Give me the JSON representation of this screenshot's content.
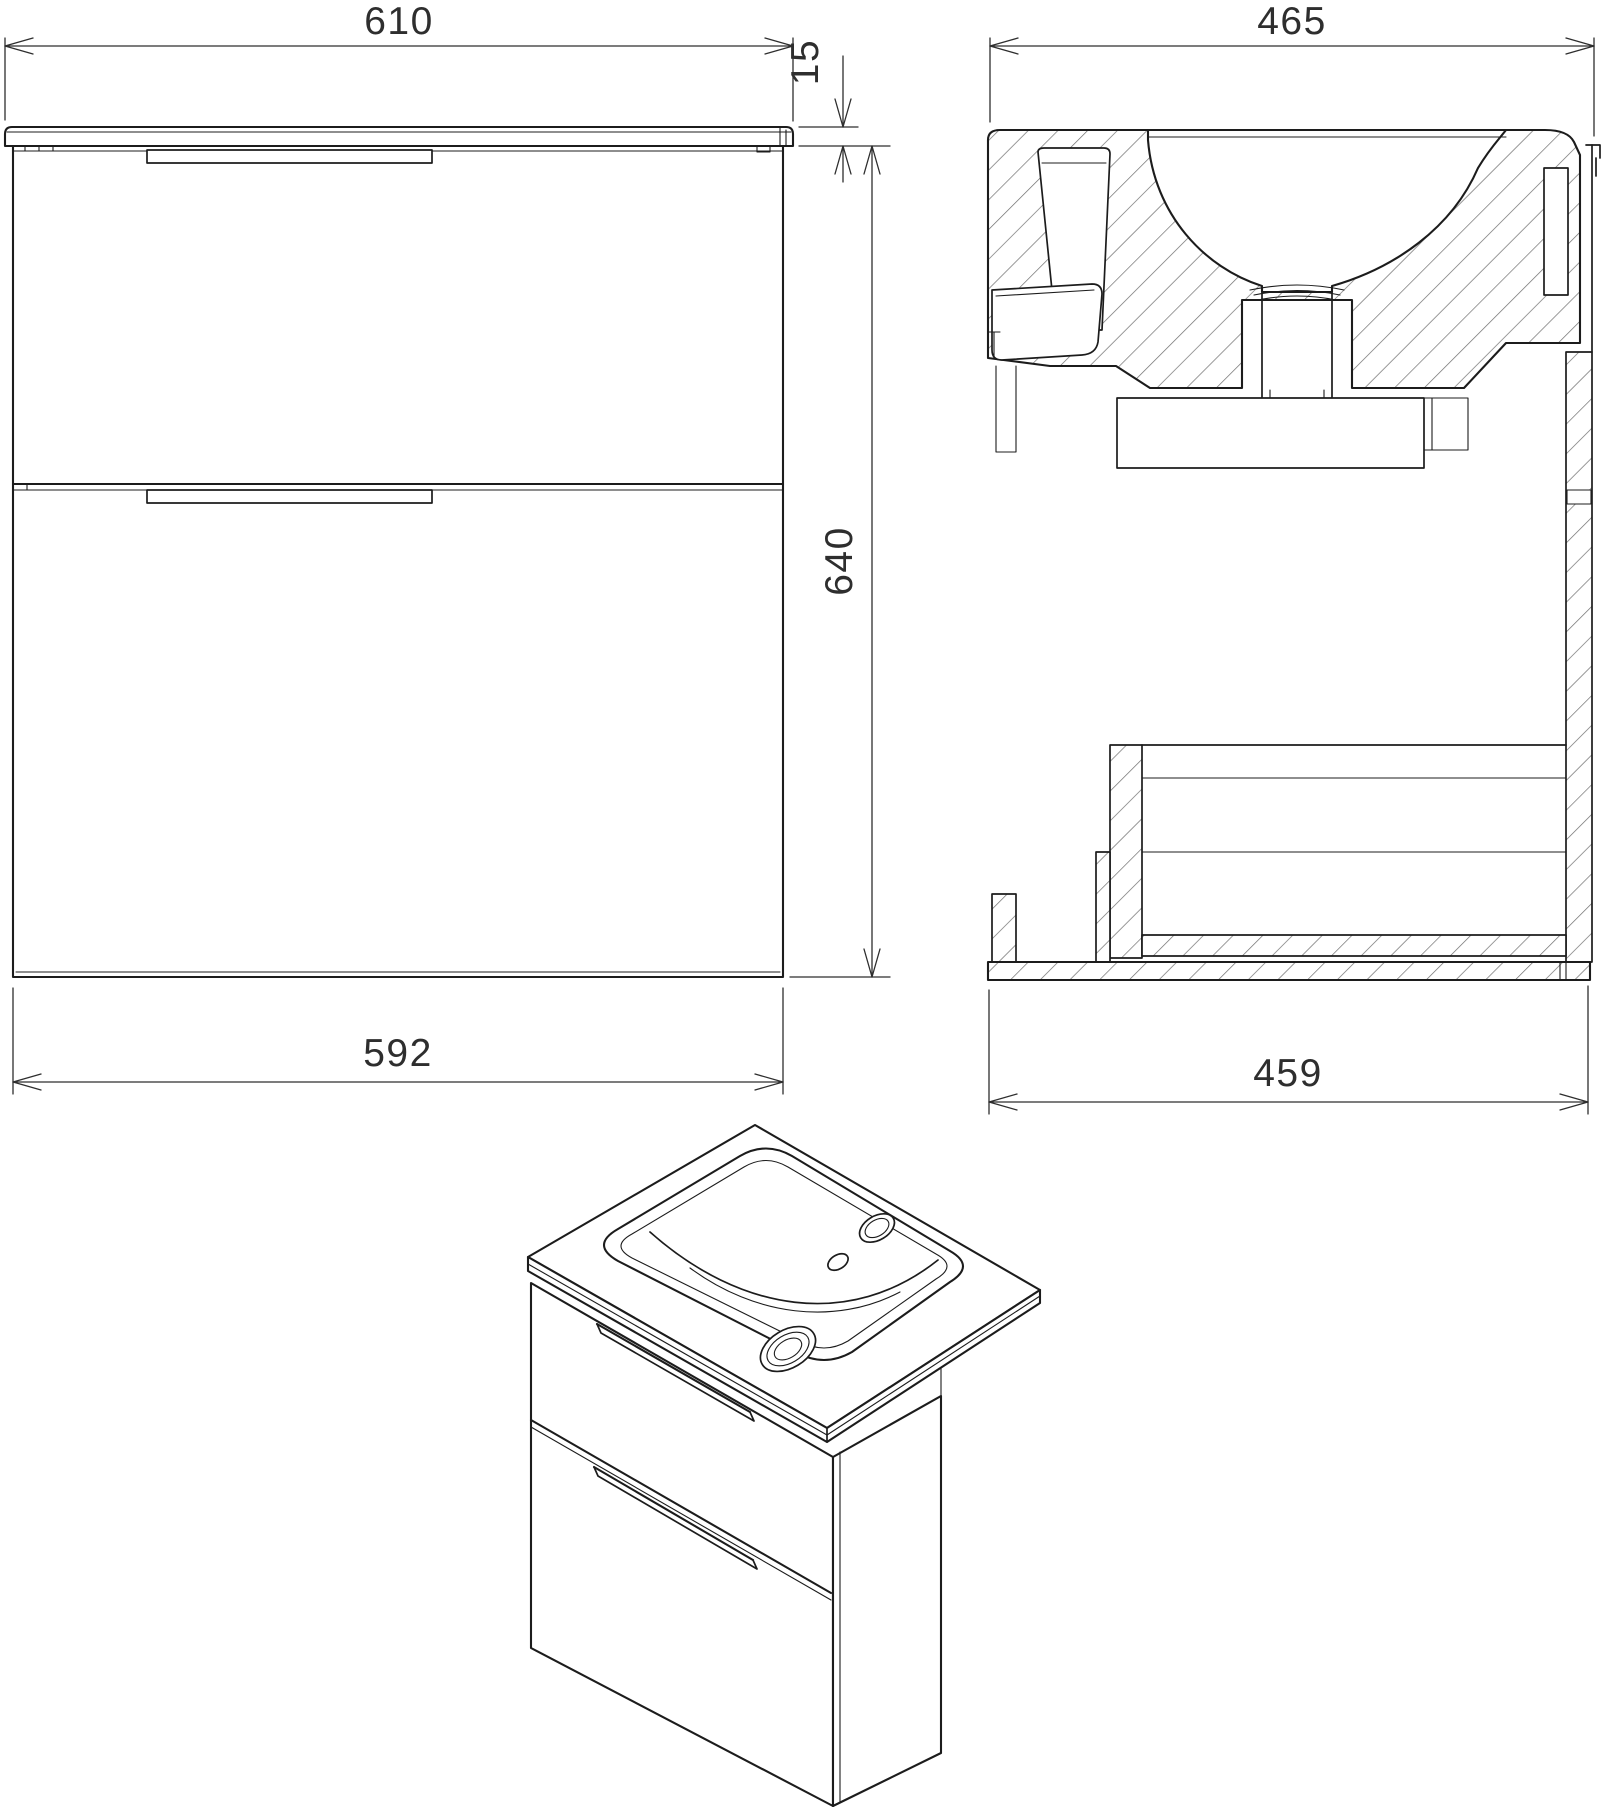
{
  "document": {
    "type": "technical-drawing",
    "subject": "wall-hung bathroom vanity unit with ceramic washbasin, two drawers"
  },
  "views": {
    "front": {
      "label": "front-elevation"
    },
    "side": {
      "label": "side-cross-section"
    },
    "isometric": {
      "label": "isometric-projection"
    }
  },
  "dimensions": {
    "countertop_width": {
      "value": "610",
      "orientation": "horizontal",
      "view": "front"
    },
    "countertop_thickness": {
      "value": "15",
      "orientation": "vertical",
      "view": "front"
    },
    "body_height": {
      "value": "640",
      "orientation": "vertical",
      "view": "front"
    },
    "body_width": {
      "value": "592",
      "orientation": "horizontal",
      "view": "front"
    },
    "countertop_depth": {
      "value": "465",
      "orientation": "horizontal",
      "view": "side"
    },
    "body_depth": {
      "value": "459",
      "orientation": "horizontal",
      "view": "side"
    }
  },
  "style": {
    "line_color": "#1c1c1c",
    "hatch_color": "#6f6f6f",
    "dimension_color": "#2e2e2e",
    "background": "#ffffff"
  }
}
